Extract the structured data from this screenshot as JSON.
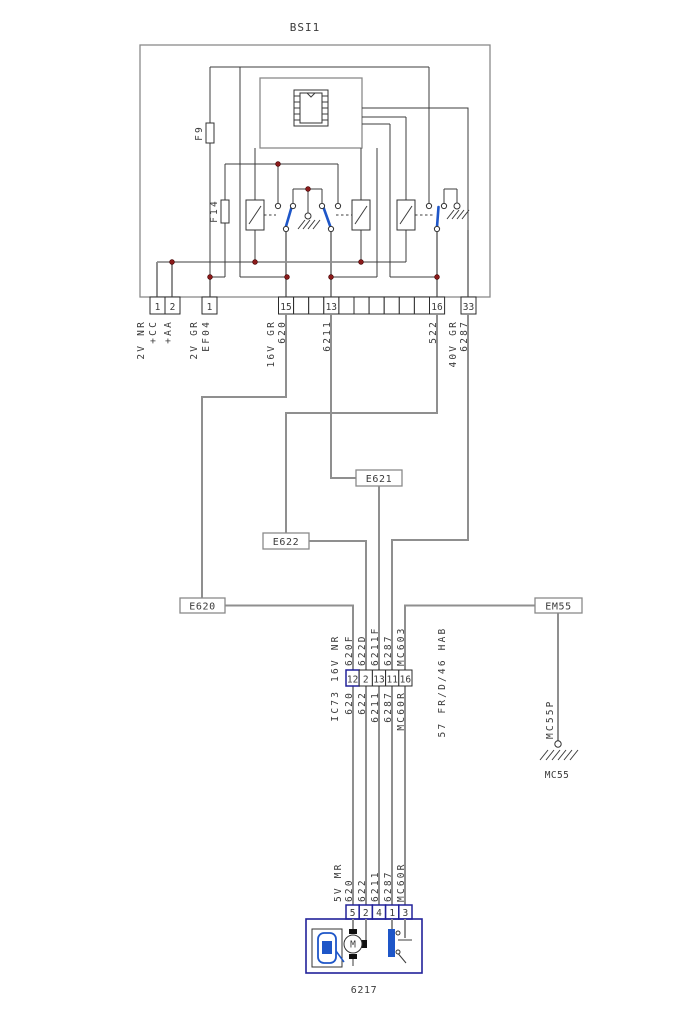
{
  "bsi": {
    "title": "BSI1",
    "fuse_f9": "F9",
    "fuse_f14": "F14",
    "pins": {
      "p1": "1",
      "p2": "2",
      "pef04": "1",
      "p15": "15",
      "p13": "13",
      "p16": "16",
      "p33": "33"
    },
    "wire_labels": {
      "nr2v": "2V NR",
      "cc": "+CC",
      "aa": "+AA",
      "gr2v": "2V GR",
      "ef04": "EF04",
      "gr16v": "16V GR",
      "w620": "620",
      "w6211": "6211",
      "w522": "522",
      "gr40v": "40V GR",
      "w6287": "6287"
    }
  },
  "splices": {
    "e621": "E621",
    "e622": "E622",
    "e620": "E620",
    "em55": "EM55"
  },
  "ic73": {
    "label": "IC73 16V NR",
    "pins": [
      "12",
      "2",
      "13",
      "11",
      "16"
    ],
    "above": [
      "620F",
      "622D",
      "6211F",
      "6287",
      "MC603"
    ],
    "below": [
      "620",
      "622",
      "6211",
      "6287",
      "MC60R"
    ],
    "harness": "57 FR/D/46 HAB"
  },
  "ground": {
    "wire": "MC55P",
    "label": "MC55"
  },
  "comp6217": {
    "label": "6217",
    "gauge": "5V MR",
    "pins": [
      "5",
      "2",
      "4",
      "1",
      "3"
    ],
    "wires": [
      "620",
      "622",
      "6211",
      "6287",
      "MC60R"
    ],
    "motor": "M"
  },
  "colors": {
    "accent_blue": "#1e56c8",
    "junction_red": "#8b1a1a",
    "wire_gray": "#8f8f8f",
    "line_dark": "#3c3c3c",
    "connector_navy": "#22229a"
  }
}
